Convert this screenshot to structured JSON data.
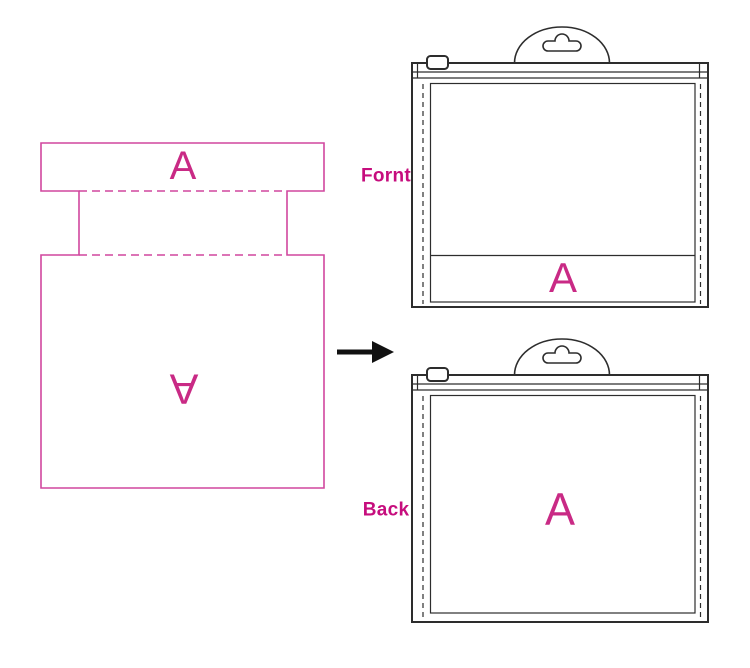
{
  "colors": {
    "background": "#ffffff",
    "template_pink": "#d1479e",
    "letter_pink": "#c92a85",
    "label_pink": "#c60d7d",
    "bag_line": "#2d2d2d",
    "arrow_black": "#111111"
  },
  "template": {
    "front_letter": "A",
    "back_letter": "A"
  },
  "bags": {
    "front": {
      "label": "Fornt",
      "letter": "A"
    },
    "back": {
      "label": "Back",
      "letter": "A"
    }
  },
  "icons": {
    "arrow": "arrow-right-icon",
    "hang_tab": "hang-tab-euro-hole-icon",
    "zipper_slider": "zipper-slider-icon"
  }
}
